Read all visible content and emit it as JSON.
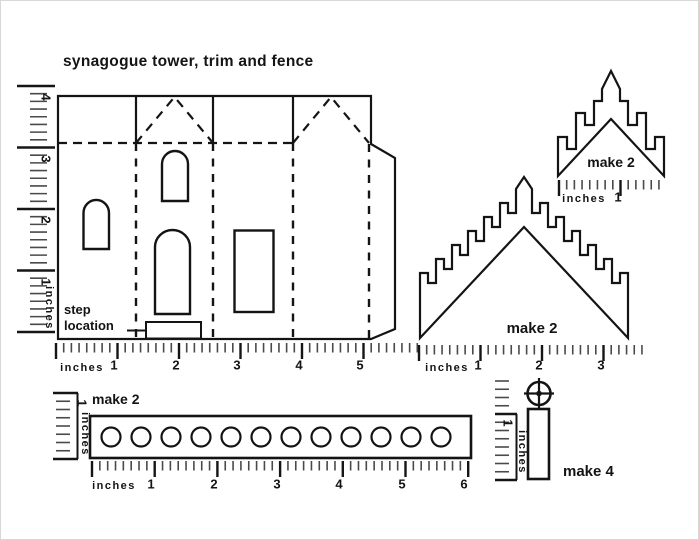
{
  "title": "synagogue tower, trim and fence",
  "tower": {
    "step_note_line1": "step",
    "step_note_line2": "location"
  },
  "trim_small": {
    "make_label": "make 2"
  },
  "trim_large": {
    "make_label": "make 2"
  },
  "fence": {
    "make_label": "make 2"
  },
  "post": {
    "make_label": "make 4"
  },
  "rulers": {
    "unit_label": "inches",
    "left_main": {
      "numbers": [
        "4",
        "3",
        "2",
        "1"
      ]
    },
    "bottom_main": {
      "numbers": [
        "1",
        "2",
        "3",
        "4",
        "5"
      ]
    },
    "trim_large_bottom": {
      "numbers": [
        "1",
        "2",
        "3"
      ]
    },
    "trim_small_bottom": {
      "numbers": [
        "1"
      ]
    },
    "fence_bottom": {
      "numbers": [
        "1",
        "2",
        "3",
        "4",
        "5",
        "6"
      ]
    },
    "fence_left": {
      "numbers": [
        "1"
      ]
    },
    "post_left": {
      "numbers": [
        "1"
      ]
    }
  },
  "colors": {
    "ink": "#1a1a1a",
    "background": "#ffffff"
  }
}
